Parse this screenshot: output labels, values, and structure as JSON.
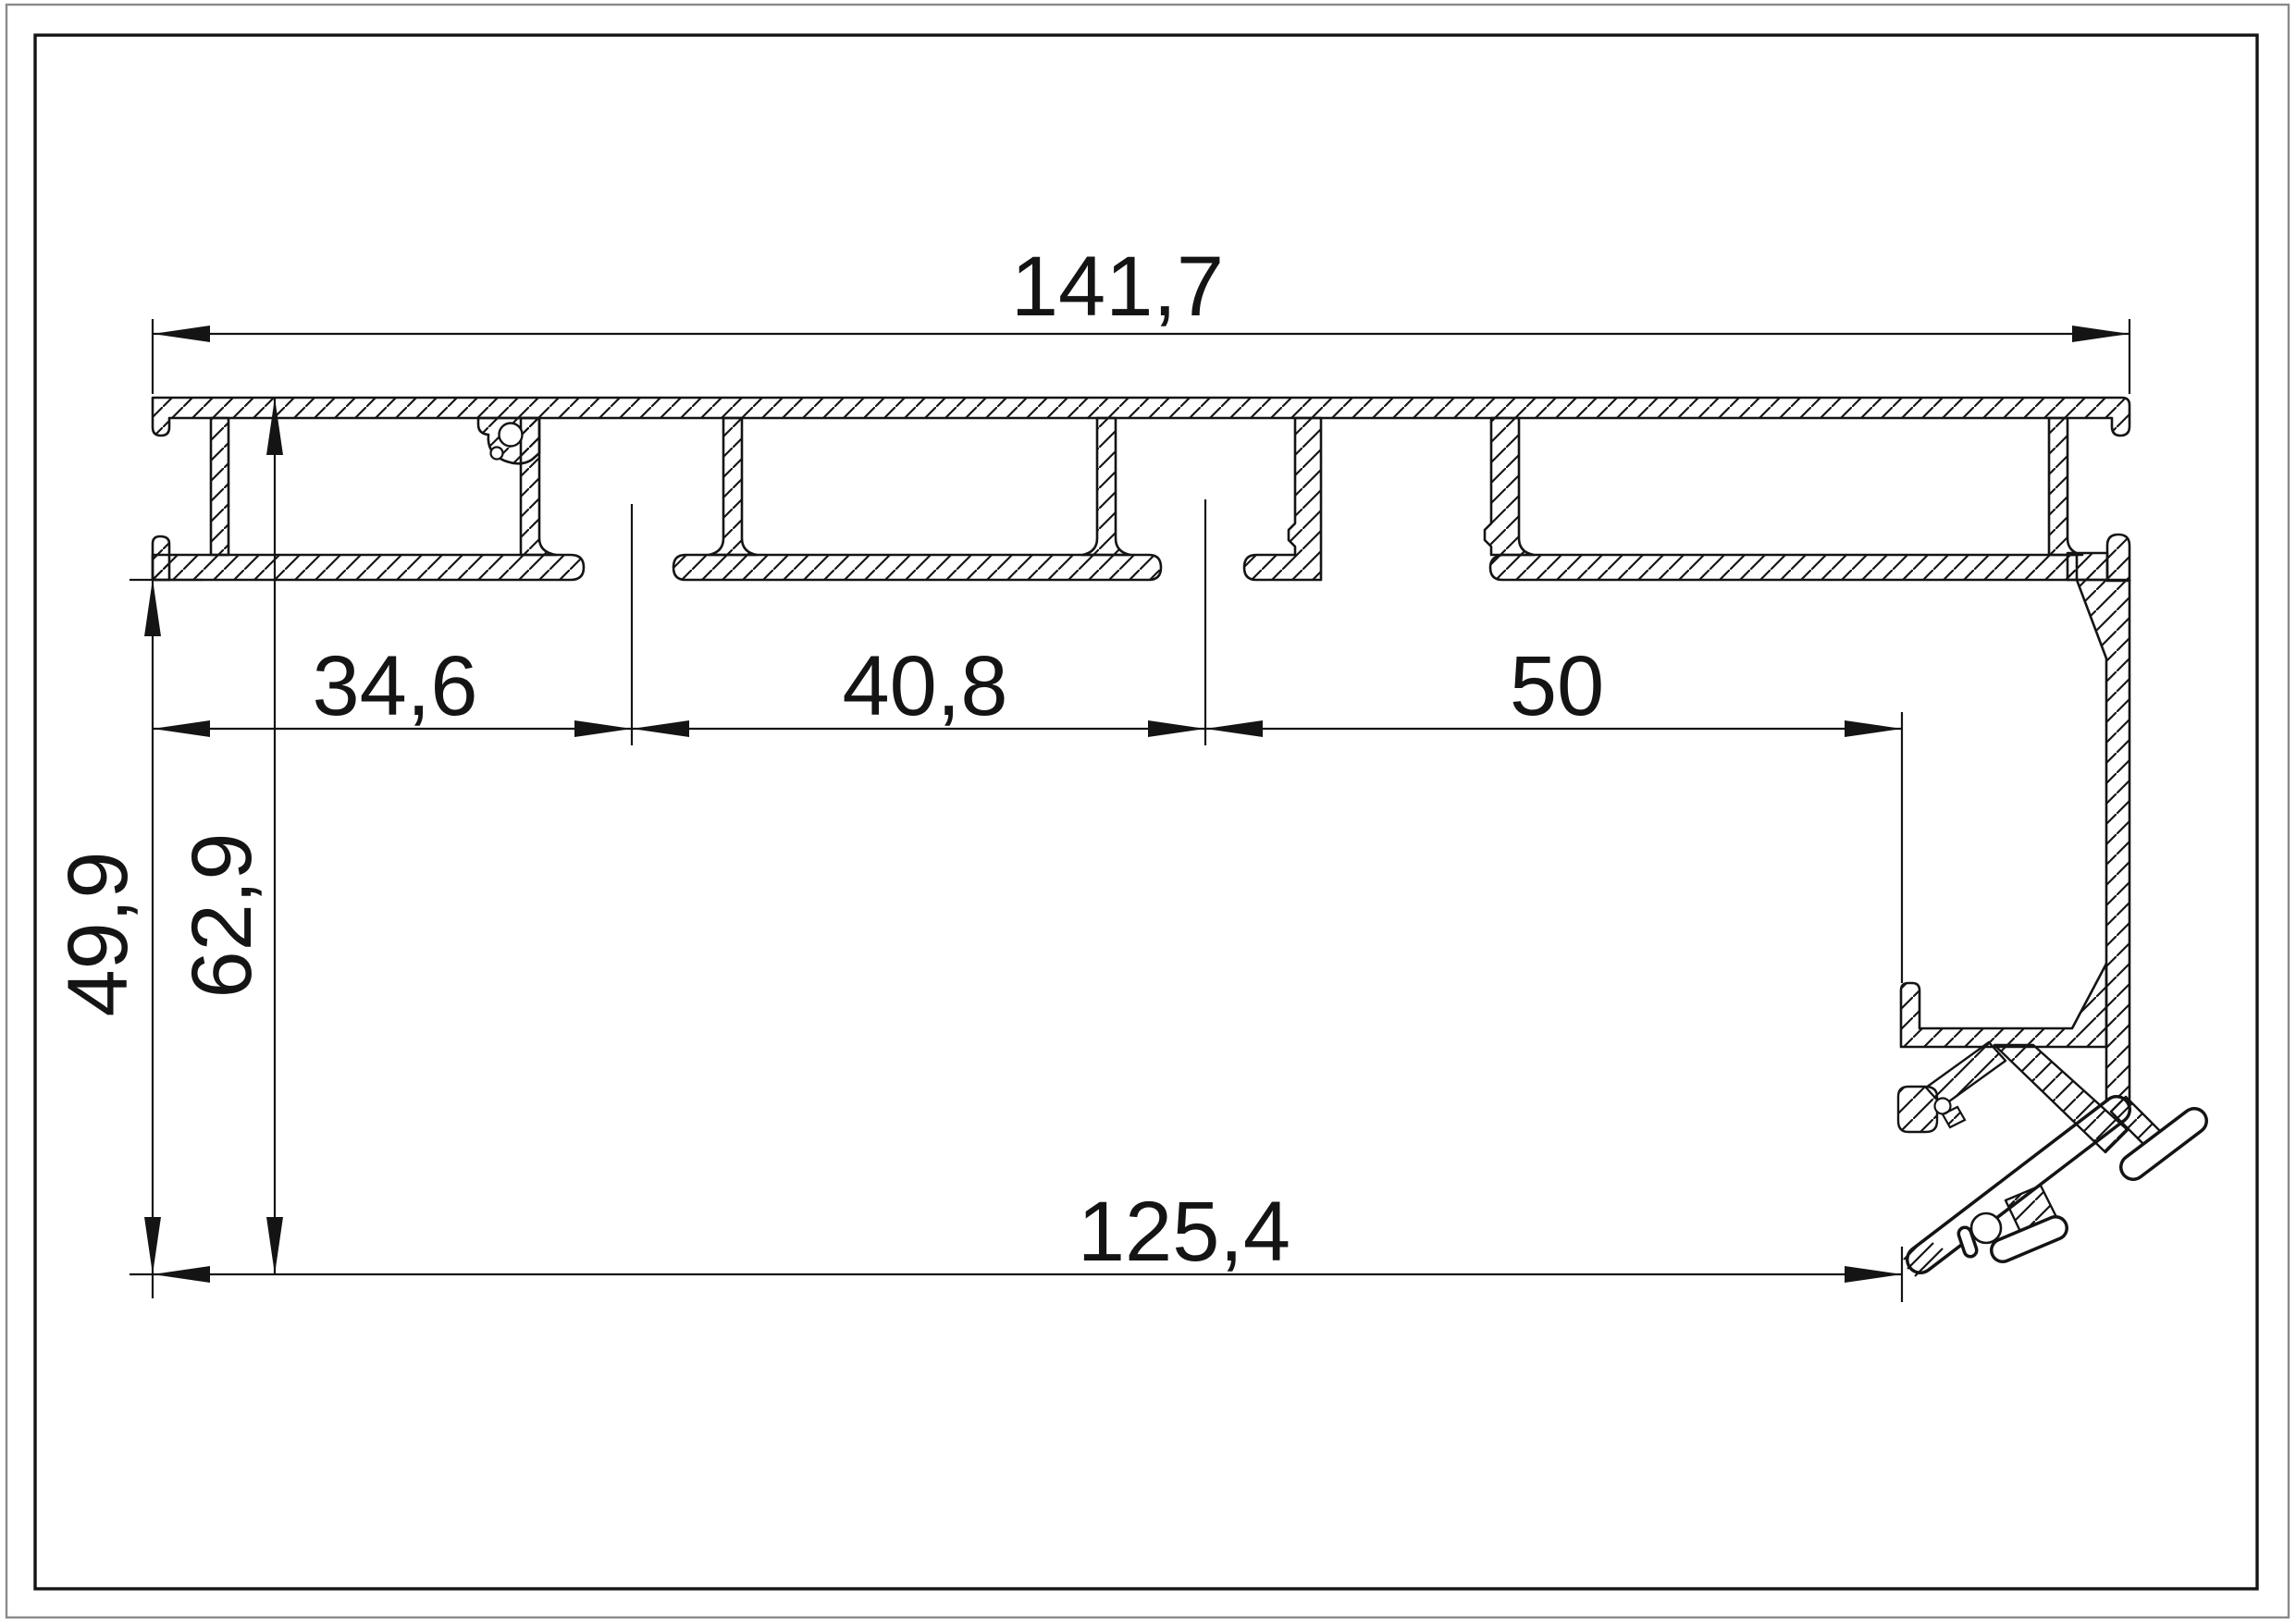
{
  "sheet": {
    "background": "#ffffff",
    "outer_border_color": "#8a8a8a",
    "inner_border_color": "#141414",
    "line_color": "#141414"
  },
  "drawing": {
    "dimensions": {
      "total_width": "141,7",
      "chain": [
        "34,6",
        "40,8",
        "50"
      ],
      "height_left": "49,9",
      "height_right": "62,9",
      "bottom_width": "125,4"
    }
  }
}
